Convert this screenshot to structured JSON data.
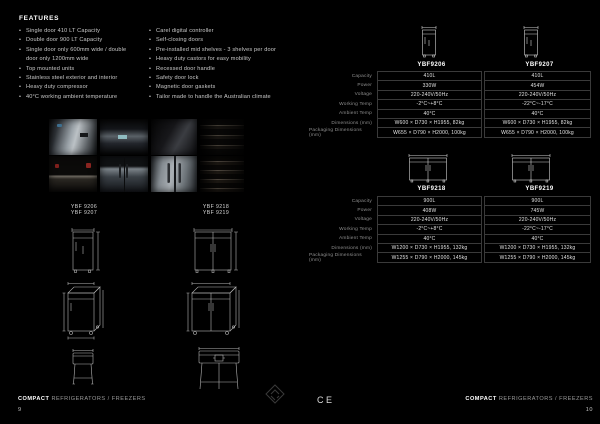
{
  "features": {
    "title": "FEATURES",
    "left": [
      "Single door 410 LT Capacity",
      "Double door 900 LT Capacity",
      "Single door only 600mm wide / double door only 1200mm wide",
      "Top mounted units",
      "Stainless steel exterior and interior",
      "Heavy duty compressor",
      "40°C working ambient temperature"
    ],
    "right": [
      "Carel digital controller",
      "Self-closing doors",
      "Pre-installed mid shelves - 3 shelves per door",
      "Heavy duty castors for easy mobility",
      "Recessed door handle",
      "Safety door lock",
      "Magnetic door gaskets",
      "Tailor made to handle the Australian climate"
    ]
  },
  "gallery": {
    "labels_left": [
      "YBF 9206",
      "YBF 9207"
    ],
    "labels_right": [
      "YBF 9218",
      "YBF 9219"
    ]
  },
  "spec_tables": [
    {
      "models": [
        "YBF9206",
        "YBF9207"
      ],
      "rows": [
        {
          "label": "Capacity",
          "values": [
            "410L",
            "410L"
          ]
        },
        {
          "label": "Power",
          "values": [
            "330W",
            "454W"
          ]
        },
        {
          "label": "Voltage",
          "values": [
            "220-240V/50Hz",
            "220-240V/50Hz"
          ]
        },
        {
          "label": "Working Temp",
          "values": [
            "-2°C~+8°C",
            "-22°C~-17°C"
          ]
        },
        {
          "label": "Ambient Temp",
          "values": [
            "40°C",
            "40°C"
          ]
        },
        {
          "label": "Dimensions (mm)",
          "values": [
            "W600 × D730 × H1955, 82kg",
            "W600 × D730 × H1955, 82kg"
          ]
        },
        {
          "label": "Packaging Dimensions (mm)",
          "values": [
            "W655 × D790 × H2000, 100kg",
            "W655 × D790 × H2000, 100kg"
          ]
        }
      ]
    },
    {
      "models": [
        "YBF9218",
        "YBF9219"
      ],
      "rows": [
        {
          "label": "Capacity",
          "values": [
            "900L",
            "900L"
          ]
        },
        {
          "label": "Power",
          "values": [
            "408W",
            "745W"
          ]
        },
        {
          "label": "Voltage",
          "values": [
            "220-240V/50Hz",
            "220-240V/50Hz"
          ]
        },
        {
          "label": "Working Temp",
          "values": [
            "-2°C~+8°C",
            "-22°C~-17°C"
          ]
        },
        {
          "label": "Ambient Temp",
          "values": [
            "40°C",
            "40°C"
          ]
        },
        {
          "label": "Dimensions (mm)",
          "values": [
            "W1200 × D730 × H1955, 132kg",
            "W1200 × D730 × H1955, 132kg"
          ]
        },
        {
          "label": "Packaging Dimensions (mm)",
          "values": [
            "W1255 × D790 × H2000, 145kg",
            "W1255 × D790 × H2000, 145kg"
          ]
        }
      ]
    }
  ],
  "footer": {
    "left": {
      "brand": "COMPACT",
      "rest": "REFRIGERATORS / FREEZERS",
      "page": "9"
    },
    "right": {
      "brand": "COMPACT",
      "rest": "REFRIGERATORS / FREEZERS",
      "page": "10"
    },
    "ce": "CE"
  },
  "colors": {
    "background": "#000000",
    "table_border": "#3a3a3a",
    "text": "#e2e2e2",
    "muted": "#8f8f8f"
  }
}
